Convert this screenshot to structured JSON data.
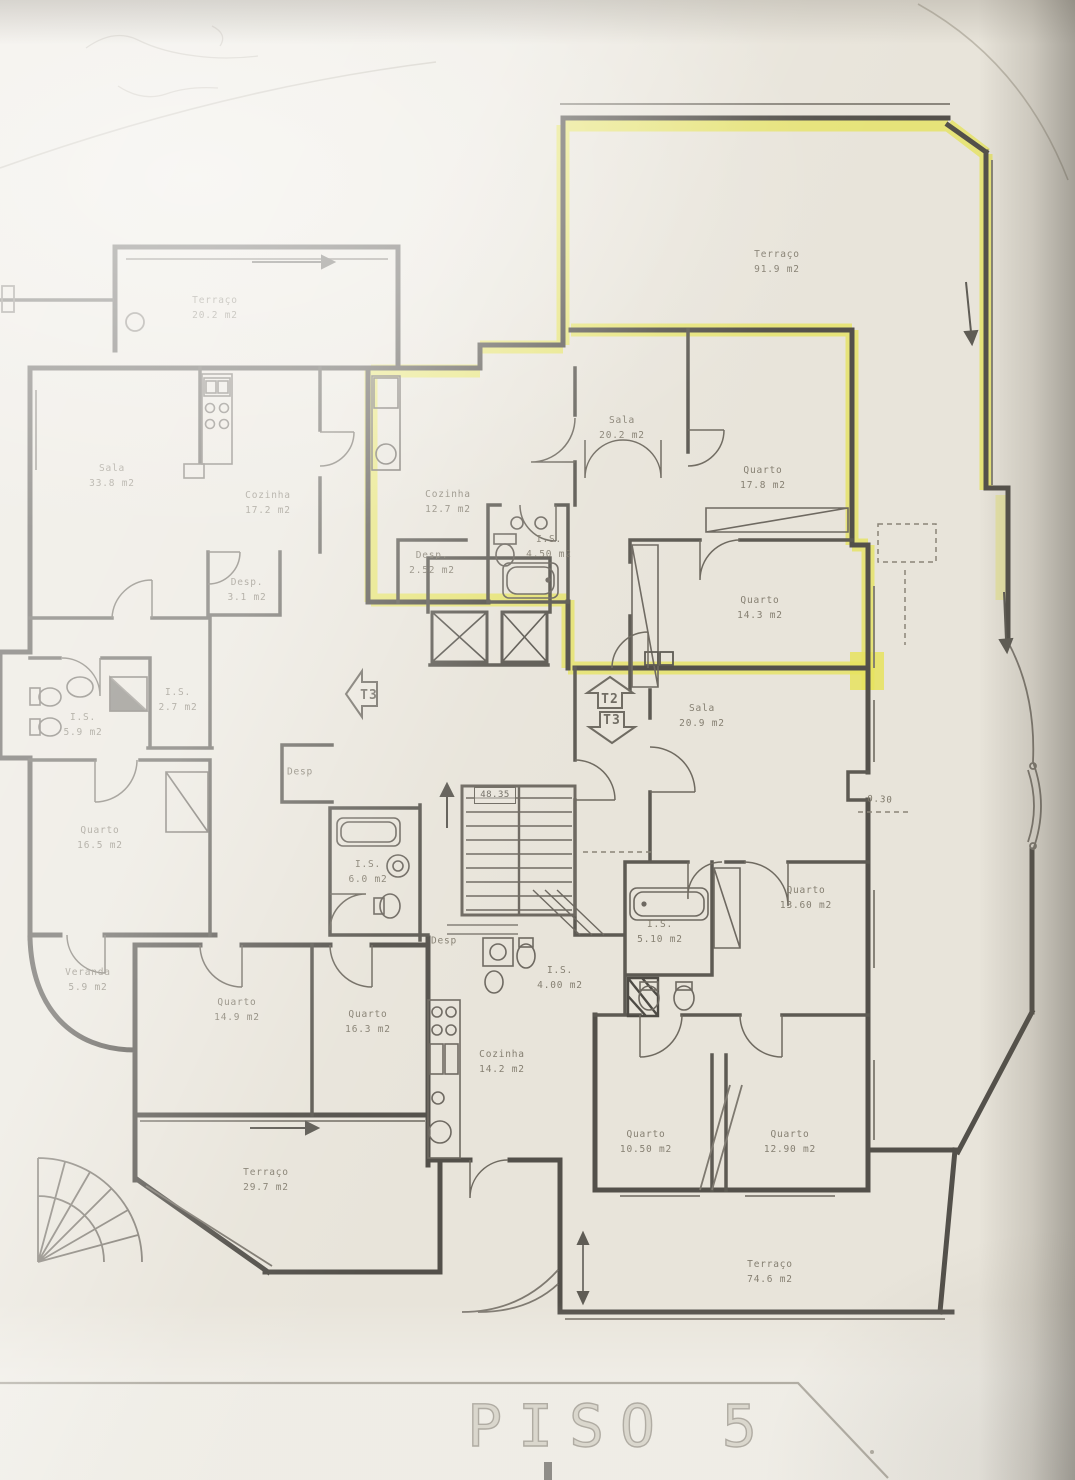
{
  "title": "PISO 5",
  "annotations": {
    "elevation": "48.35",
    "dimension": "0.30"
  },
  "colors": {
    "paper": "#e8e4da",
    "wall": "#53504a",
    "highlight": "#e6e35e",
    "ink": "#7d7769"
  },
  "unit_markers": [
    {
      "label": "T3",
      "direction": "left",
      "x": 362,
      "y": 694
    },
    {
      "label": "T2",
      "direction": "up",
      "x": 610,
      "y": 693
    },
    {
      "label": "T3",
      "direction": "down",
      "x": 612,
      "y": 727
    }
  ],
  "rooms": [
    {
      "name": "Terraço",
      "area": "20.2 m2",
      "x": 215,
      "y": 308
    },
    {
      "name": "Terraço",
      "area": "91.9 m2",
      "x": 777,
      "y": 262
    },
    {
      "name": "Sala",
      "area": "33.8 m2",
      "x": 112,
      "y": 476
    },
    {
      "name": "Cozinha",
      "area": "17.2 m2",
      "x": 268,
      "y": 503
    },
    {
      "name": "Cozinha",
      "area": "12.7 m2",
      "x": 448,
      "y": 502
    },
    {
      "name": "Sala",
      "area": "20.2 m2",
      "x": 622,
      "y": 428
    },
    {
      "name": "Quarto",
      "area": "17.8 m2",
      "x": 763,
      "y": 478
    },
    {
      "name": "Desp.",
      "area": "2.52 m2",
      "x": 432,
      "y": 563
    },
    {
      "name": "I.S.",
      "area": "4.50 m2",
      "x": 549,
      "y": 547
    },
    {
      "name": "Desp.",
      "area": "3.1 m2",
      "x": 247,
      "y": 590
    },
    {
      "name": "Quarto",
      "area": "14.3 m2",
      "x": 760,
      "y": 608
    },
    {
      "name": "I.S.",
      "area": "5.9 m2",
      "x": 83,
      "y": 725
    },
    {
      "name": "I.S.",
      "area": "2.7 m2",
      "x": 178,
      "y": 700
    },
    {
      "name": "Sala",
      "area": "20.9 m2",
      "x": 702,
      "y": 716
    },
    {
      "name": "Quarto",
      "area": "16.5 m2",
      "x": 100,
      "y": 838
    },
    {
      "name": "Desp",
      "area": "",
      "x": 300,
      "y": 772
    },
    {
      "name": "I.S.",
      "area": "6.0 m2",
      "x": 368,
      "y": 872
    },
    {
      "name": "Quarto",
      "area": "13.60 m2",
      "x": 806,
      "y": 898
    },
    {
      "name": "I.S.",
      "area": "5.10 m2",
      "x": 660,
      "y": 932
    },
    {
      "name": "Desp",
      "area": "",
      "x": 444,
      "y": 941
    },
    {
      "name": "I.S.",
      "area": "4.00 m2",
      "x": 560,
      "y": 978
    },
    {
      "name": "Veranda",
      "area": "5.9 m2",
      "x": 88,
      "y": 980
    },
    {
      "name": "Quarto",
      "area": "14.9 m2",
      "x": 237,
      "y": 1010
    },
    {
      "name": "Quarto",
      "area": "16.3 m2",
      "x": 368,
      "y": 1022
    },
    {
      "name": "Cozinha",
      "area": "14.2 m2",
      "x": 502,
      "y": 1062
    },
    {
      "name": "Quarto",
      "area": "10.50 m2",
      "x": 646,
      "y": 1142
    },
    {
      "name": "Quarto",
      "area": "12.90 m2",
      "x": 790,
      "y": 1142
    },
    {
      "name": "Terraço",
      "area": "29.7 m2",
      "x": 266,
      "y": 1180
    },
    {
      "name": "Terraço",
      "area": "74.6 m2",
      "x": 770,
      "y": 1272
    }
  ]
}
